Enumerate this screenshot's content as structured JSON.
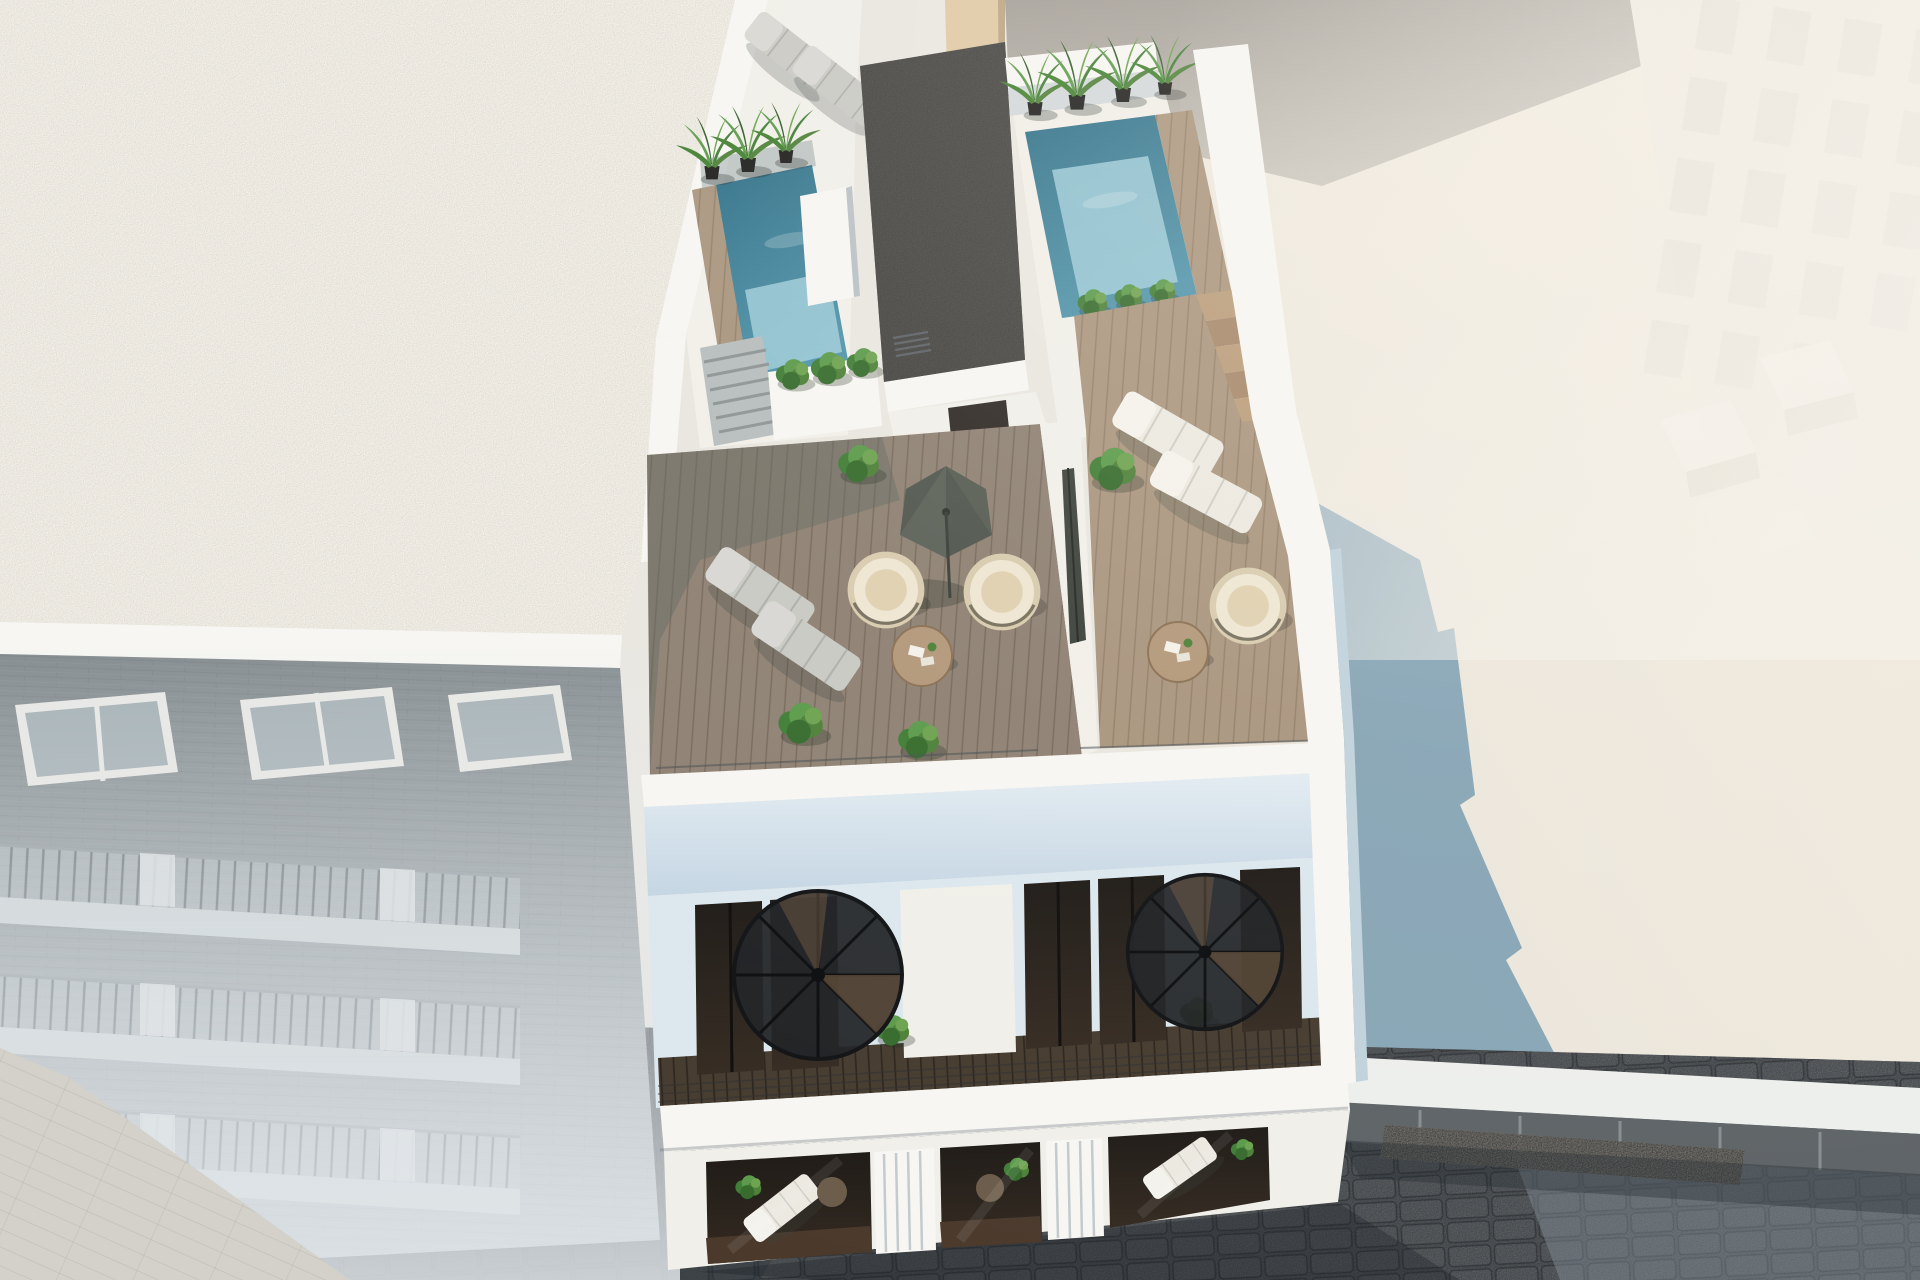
{
  "scene": {
    "type": "architectural-3d-render",
    "view": "aerial-three-quarter-top-down",
    "subject": "new-build white apartment block with rooftop pools and terraces between older neighbouring buildings",
    "time_of_day": "bright daylight",
    "visible_text": ""
  },
  "palette": {
    "bg": "#e9e6e0",
    "left_roof": "#d8d2c5",
    "parapet_white": "#f7f6f2",
    "main_white": "#f1efe9",
    "wall_shade_top": "#e3ecf2",
    "wall_shade": "#c4d5e3",
    "penthouse_wall": "#dce7ee",
    "deck_wood_left": "#8e8173",
    "deck_wood_right": "#a9957e",
    "deck_shadow": "#60665f",
    "pool_deep": "#2e6e86",
    "pool_mid": "#4f93aa",
    "pool_light": "#9ccbd8",
    "gravel": "#55514a",
    "brick_top": "#7b8387",
    "brick_bottom": "#b3babd",
    "slab_light": "#ccd3d4",
    "window_glass": "#a0acb1",
    "street_dark": "#3d4851",
    "street_mid": "#5c6770",
    "street_lit": "#7d8892",
    "pavement": "#cdc7ba",
    "roof_plane": "#e9e4da",
    "roof_plane_warm": "#f2ebdf",
    "shadow_blue": "#82a1b3",
    "wall_grey": "#a39e97",
    "beige_strip": "#dfc8a4",
    "top_building": "#ece7de",
    "top_window": "#d8d3cb",
    "low_build_white": "#edefec",
    "shop_dark": "#5d6266",
    "floor_dark": "#453a2e",
    "door_glass": "#2d2824",
    "stair_black": "#1f2124",
    "rail_dark": "#2b2e31",
    "plant_green": "#4d8038",
    "plant_dark": "#2f5b28",
    "plant_light": "#6ca24f",
    "pot_dark": "#1c1c1b",
    "lounger_grey": "#c9c9c4",
    "lounger_white": "#ece9e1",
    "cushion": "#d8c7aa",
    "umbrella_dark": "#565c53",
    "table_wood": "#b3987a",
    "void_dark": "#1d1915",
    "side_shade": "#c0d2dc"
  },
  "inventory": {
    "rooftop_pools": 2,
    "potted_palms": 7,
    "potted_bushes": 11,
    "sun_loungers": 8,
    "hanging_egg_chairs": 3,
    "parasols": 2,
    "round_tables": 4,
    "spiral_staircases": 2,
    "gravel_roof_sections": 2,
    "balcony_rows_left_building": 3,
    "windows_left_building": 3,
    "neighbour_buildings": [
      "brick apartment block left",
      "white tower top right",
      "low shop fronts along street"
    ]
  }
}
